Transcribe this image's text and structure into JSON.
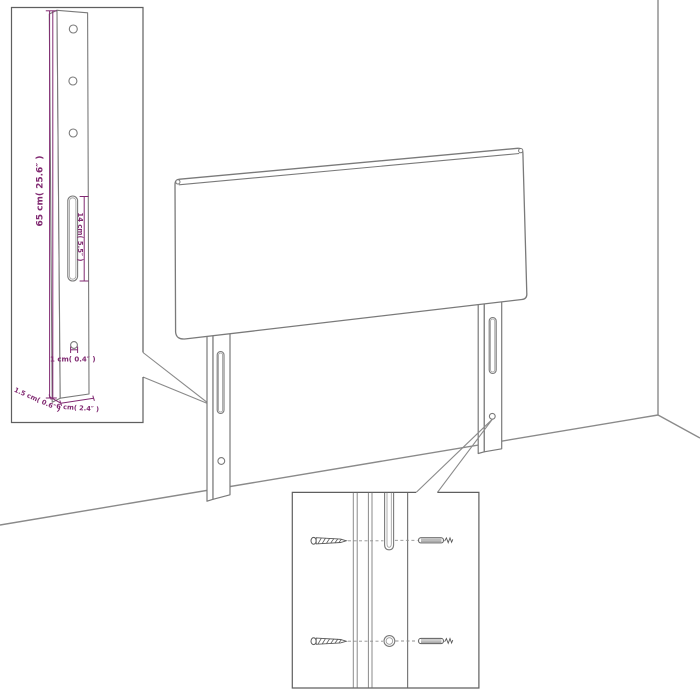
{
  "diagram": {
    "subject": "headboard-with-mounting-legs-dimension-diagram"
  },
  "colors": {
    "background": "#ffffff",
    "outline_gray": "#7a7a7a",
    "room_line_gray": "#8a8a8a",
    "inset_border_gray": "#5f5f5f",
    "screw_gray": "#5a5a5a",
    "dimension_magenta": "#812a72"
  },
  "dimensions": {
    "leg_height": "65 cm( 25.6″ )",
    "slot_length": "14 cm( 5.5″ )",
    "hole_size": "1 cm( 0.4″ )",
    "leg_depth": "1.5 cm( 0.6″ )",
    "leg_width": "6 cm( 2.4″ )"
  }
}
